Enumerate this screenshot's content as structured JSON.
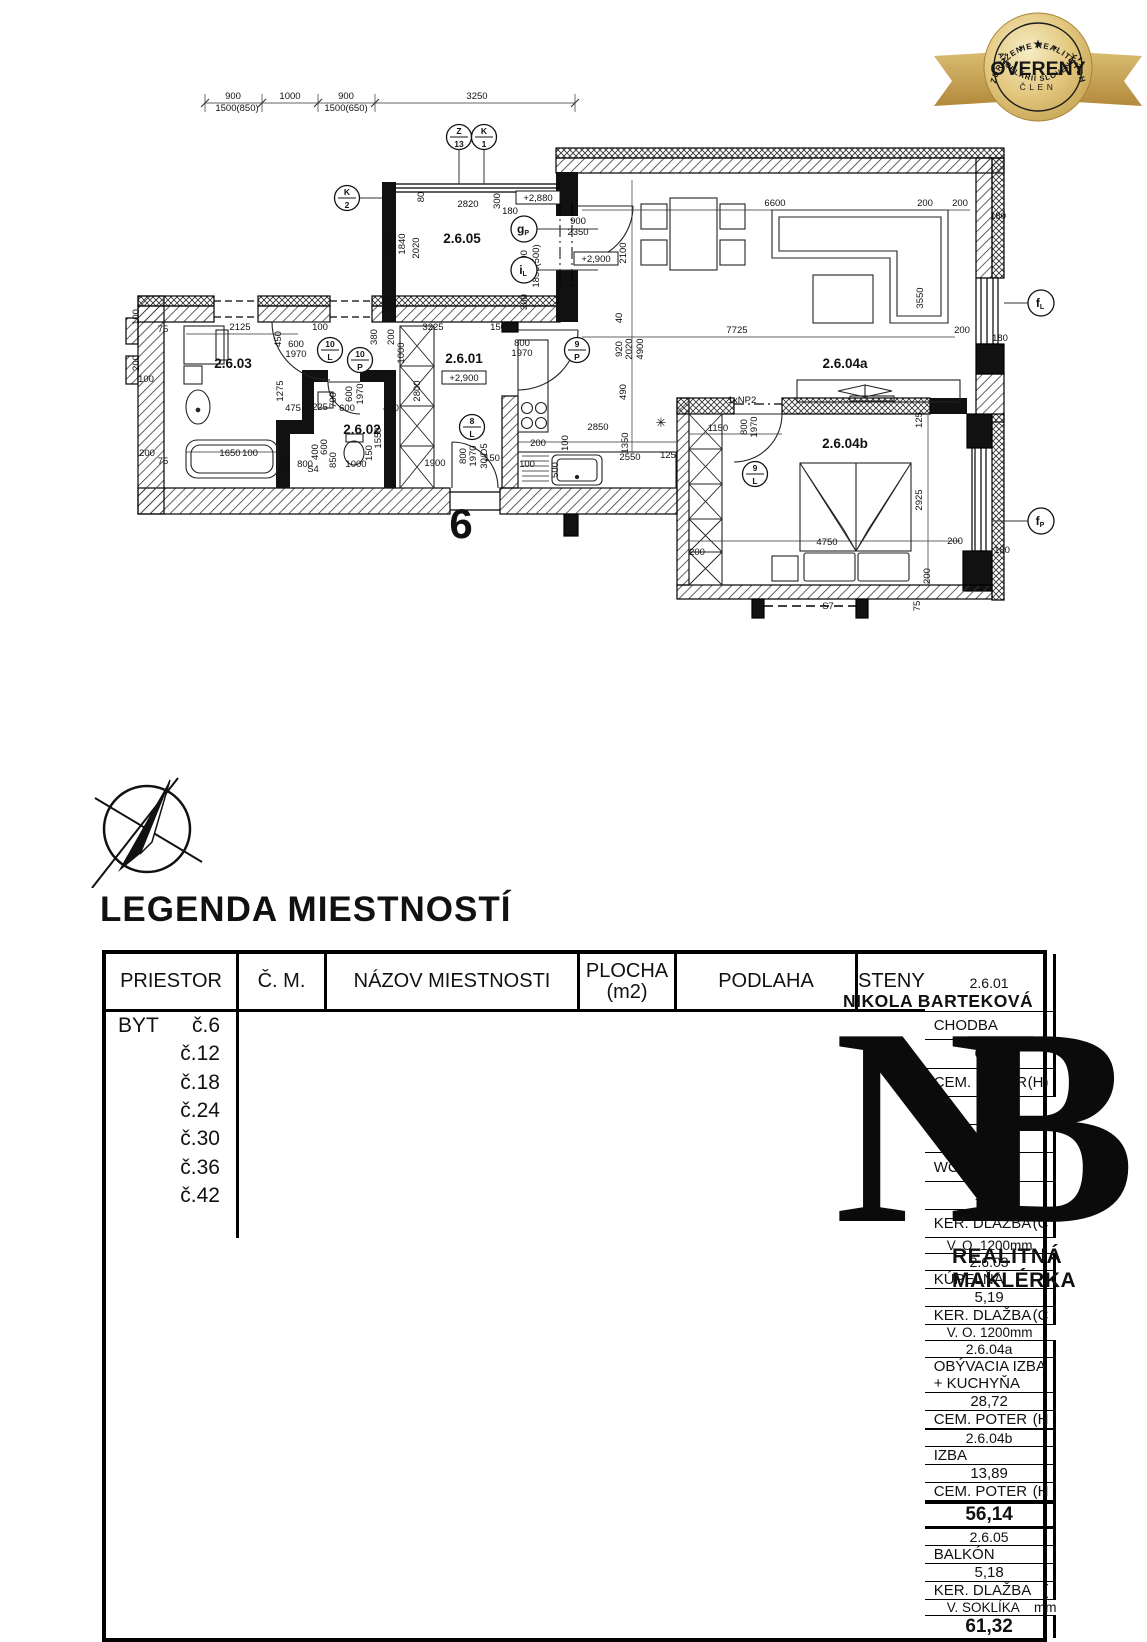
{
  "badge": {
    "top": "ZDRUŽENIE REALITNÝCH",
    "center": "OVERENÝ",
    "sub": "ČLEN",
    "bottom": "KANCELÁRIÍ SLOVENSKA",
    "gold_dark": "#b3893b",
    "gold_light": "#f3e3ae"
  },
  "legend_title": "LEGENDA  MIESTNOSTÍ",
  "table": {
    "headers": {
      "priestor": "PRIESTOR",
      "cm": "Č. M.",
      "nazov": "NÁZOV MIESTNOSTI",
      "plocha1": "PLOCHA",
      "plocha2": "(m2)",
      "podlaha": "PODLAHA",
      "steny": "STENY"
    },
    "byt": "BYT",
    "rows": [
      {
        "num": "č.6",
        "cm": "2.6.01",
        "nazov": "CHODBA",
        "plocha": "6,64",
        "podlaha": "CEM. POTER",
        "kod": "(H)",
        "steny": "",
        "total": false
      },
      {
        "num": "č.12",
        "cm": "2.6.02",
        "nazov": "WC",
        "plocha": "1,70",
        "podlaha": "KER. DLAŽBA",
        "kod": "(C",
        "steny": "V. O. 1200mm",
        "total": false
      },
      {
        "num": "č.18",
        "cm": "2.6.03",
        "nazov": "KÚPELŇA",
        "plocha": "5,19",
        "podlaha": "KER. DLAŽBA",
        "kod": "(C",
        "steny": "V. O. 1200mm",
        "total": false
      },
      {
        "num": "č.24",
        "cm": "2.6.04a",
        "nazov": "OBÝVACIA IZBA + KUCHYŇA",
        "plocha": "28,72",
        "podlaha": "CEM. POTER",
        "kod": "(H",
        "steny": "",
        "total": false
      },
      {
        "num": "č.30",
        "cm": "2.6.04b",
        "nazov": "IZBA",
        "plocha": "13,89",
        "podlaha": "CEM. POTER",
        "kod": "(H",
        "steny": "",
        "total": false
      },
      {
        "num": "č.36",
        "cm": "",
        "nazov": "",
        "plocha": "56,14",
        "podlaha": "",
        "kod": "",
        "steny": "",
        "total": true
      },
      {
        "num": "č.42",
        "cm": "2.6.05",
        "nazov": "BALKÓN",
        "plocha": "5,18",
        "podlaha": "KER. DLAŽBA",
        "kod": "(",
        "steny": "V. SOKLÍKA    mm",
        "total": false
      },
      {
        "num": "",
        "cm": "",
        "nazov": "",
        "plocha": "61,32",
        "podlaha": "",
        "kod": "",
        "steny": "",
        "total": true
      }
    ]
  },
  "watermark": {
    "name": "NIKOLA BARTEKOVÁ",
    "monogram_n": "N",
    "monogram_b": "B",
    "role": "REALITNÁ MAKLÉRKA"
  },
  "plan": {
    "big_number": "6",
    "rooms": [
      {
        "t": "2.6.05",
        "x": 462,
        "y": 243
      },
      {
        "t": "2.6.01",
        "x": 464,
        "y": 363
      },
      {
        "t": "2.6.02",
        "x": 362,
        "y": 434
      },
      {
        "t": "2.6.03",
        "x": 233,
        "y": 368
      },
      {
        "t": "2.6.04a",
        "x": 845,
        "y": 368
      },
      {
        "t": "2.6.04b",
        "x": 845,
        "y": 448
      }
    ],
    "markers": [
      {
        "a": "Z",
        "b": "13",
        "x": 459,
        "y": 137
      },
      {
        "a": "K",
        "b": "1",
        "x": 484,
        "y": 137
      },
      {
        "a": "K",
        "b": "2",
        "x": 347,
        "y": 198
      },
      {
        "a": "10",
        "b": "L",
        "x": 330,
        "y": 350
      },
      {
        "a": "10",
        "b": "P",
        "x": 360,
        "y": 360
      },
      {
        "a": "9",
        "b": "P",
        "x": 577,
        "y": 350
      },
      {
        "a": "8",
        "b": "L",
        "x": 472,
        "y": 427
      },
      {
        "a": "9",
        "b": "L",
        "x": 755,
        "y": 474
      }
    ],
    "letter_markers": [
      {
        "a": "g",
        "b": "P",
        "x": 524,
        "y": 229
      },
      {
        "a": "i",
        "b": "L",
        "x": 524,
        "y": 270
      },
      {
        "a": "f",
        "b": "L",
        "x": 1041,
        "y": 303
      },
      {
        "a": "f",
        "b": "P",
        "x": 1041,
        "y": 521
      }
    ],
    "elevations": [
      {
        "t": "+2,880",
        "x": 538,
        "y": 200
      },
      {
        "t": "+2,900",
        "x": 596,
        "y": 261
      },
      {
        "t": "+2,900",
        "x": 464,
        "y": 380
      }
    ],
    "annotations": [
      {
        "t": "1xNP2",
        "x": 742,
        "y": 403
      },
      {
        "t": "S4",
        "x": 313,
        "y": 472
      },
      {
        "t": "S7",
        "x": 828,
        "y": 609
      },
      {
        "t": "✳",
        "x": 661,
        "y": 427
      }
    ],
    "dims": [
      {
        "t": "900",
        "x": 233,
        "y": 99
      },
      {
        "t": "1000",
        "x": 290,
        "y": 99
      },
      {
        "t": "900",
        "x": 346,
        "y": 99
      },
      {
        "t": "3250",
        "x": 477,
        "y": 99
      },
      {
        "t": "1500(850)",
        "x": 237,
        "y": 111
      },
      {
        "t": "1500(650)",
        "x": 346,
        "y": 111
      },
      {
        "t": "2820",
        "x": 468,
        "y": 207
      },
      {
        "t": "180",
        "x": 510,
        "y": 214
      },
      {
        "t": "300",
        "x": 500,
        "y": 201,
        "r": 1
      },
      {
        "t": "80",
        "x": 424,
        "y": 197,
        "r": 1
      },
      {
        "t": "1920",
        "x": 391,
        "y": 244,
        "r": 1
      },
      {
        "t": "1840",
        "x": 405,
        "y": 244,
        "r": 1
      },
      {
        "t": "2020",
        "x": 419,
        "y": 248,
        "r": 1
      },
      {
        "t": "900",
        "x": 578,
        "y": 224
      },
      {
        "t": "2350",
        "x": 578,
        "y": 235
      },
      {
        "t": "600",
        "x": 527,
        "y": 258,
        "r": 1
      },
      {
        "t": "1850(500)",
        "x": 539,
        "y": 266,
        "r": 1
      },
      {
        "t": "300",
        "x": 527,
        "y": 302,
        "r": 1
      },
      {
        "t": "180",
        "x": 392,
        "y": 303,
        "r": 1
      },
      {
        "t": "6600",
        "x": 775,
        "y": 206
      },
      {
        "t": "200",
        "x": 925,
        "y": 206
      },
      {
        "t": "200",
        "x": 960,
        "y": 206
      },
      {
        "t": "180",
        "x": 998,
        "y": 219
      },
      {
        "t": "2100",
        "x": 626,
        "y": 253,
        "r": 1
      },
      {
        "t": "3550",
        "x": 923,
        "y": 298,
        "r": 1
      },
      {
        "t": "7725",
        "x": 737,
        "y": 333
      },
      {
        "t": "200",
        "x": 962,
        "y": 333
      },
      {
        "t": "180",
        "x": 1000,
        "y": 341
      },
      {
        "t": "40",
        "x": 622,
        "y": 318,
        "r": 1
      },
      {
        "t": "920",
        "x": 622,
        "y": 349,
        "r": 1
      },
      {
        "t": "2020",
        "x": 632,
        "y": 349,
        "r": 1
      },
      {
        "t": "4900",
        "x": 643,
        "y": 349,
        "r": 1
      },
      {
        "t": "490",
        "x": 626,
        "y": 392,
        "r": 1
      },
      {
        "t": "2125",
        "x": 240,
        "y": 330
      },
      {
        "t": "100",
        "x": 320,
        "y": 330
      },
      {
        "t": "450",
        "x": 281,
        "y": 339,
        "r": 1
      },
      {
        "t": "600",
        "x": 296,
        "y": 347
      },
      {
        "t": "1970",
        "x": 296,
        "y": 357
      },
      {
        "t": "380",
        "x": 377,
        "y": 337,
        "r": 1
      },
      {
        "t": "200",
        "x": 394,
        "y": 337,
        "r": 1
      },
      {
        "t": "1000",
        "x": 404,
        "y": 353,
        "r": 1
      },
      {
        "t": "3225",
        "x": 433,
        "y": 330
      },
      {
        "t": "150",
        "x": 498,
        "y": 330
      },
      {
        "t": "800",
        "x": 522,
        "y": 346
      },
      {
        "t": "1970",
        "x": 522,
        "y": 356
      },
      {
        "t": "1275",
        "x": 283,
        "y": 391,
        "r": 1
      },
      {
        "t": "475",
        "x": 293,
        "y": 411
      },
      {
        "t": "225",
        "x": 320,
        "y": 410
      },
      {
        "t": "700",
        "x": 336,
        "y": 400,
        "r": 1
      },
      {
        "t": "600",
        "x": 347,
        "y": 411
      },
      {
        "t": "400",
        "x": 391,
        "y": 411
      },
      {
        "t": "600",
        "x": 352,
        "y": 394,
        "r": 1
      },
      {
        "t": "1970",
        "x": 363,
        "y": 394,
        "r": 1
      },
      {
        "t": "1550",
        "x": 381,
        "y": 438,
        "r": 1
      },
      {
        "t": "2800",
        "x": 420,
        "y": 391,
        "r": 1
      },
      {
        "t": "1650",
        "x": 230,
        "y": 456
      },
      {
        "t": "100",
        "x": 250,
        "y": 456
      },
      {
        "t": "200",
        "x": 147,
        "y": 456
      },
      {
        "t": "75",
        "x": 163,
        "y": 332
      },
      {
        "t": "75",
        "x": 163,
        "y": 464
      },
      {
        "t": "100",
        "x": 139,
        "y": 317,
        "r": 1
      },
      {
        "t": "200",
        "x": 139,
        "y": 363,
        "r": 1
      },
      {
        "t": "100",
        "x": 146,
        "y": 382
      },
      {
        "t": "900",
        "x": 289,
        "y": 463,
        "r": 1
      },
      {
        "t": "800",
        "x": 305,
        "y": 467
      },
      {
        "t": "400",
        "x": 318,
        "y": 452,
        "r": 1
      },
      {
        "t": "600",
        "x": 327,
        "y": 447,
        "r": 1
      },
      {
        "t": "850",
        "x": 336,
        "y": 460,
        "r": 1
      },
      {
        "t": "1000",
        "x": 356,
        "y": 467
      },
      {
        "t": "150",
        "x": 372,
        "y": 453,
        "r": 1
      },
      {
        "t": "1900",
        "x": 435,
        "y": 466
      },
      {
        "t": "150",
        "x": 492,
        "y": 461
      },
      {
        "t": "800",
        "x": 466,
        "y": 456,
        "r": 1
      },
      {
        "t": "1970",
        "x": 476,
        "y": 456,
        "r": 1
      },
      {
        "t": "30/D5",
        "x": 487,
        "y": 456,
        "r": 1
      },
      {
        "t": "2850",
        "x": 598,
        "y": 430
      },
      {
        "t": "1350",
        "x": 628,
        "y": 443,
        "r": 1
      },
      {
        "t": "200",
        "x": 538,
        "y": 446
      },
      {
        "t": "100",
        "x": 568,
        "y": 443,
        "r": 1
      },
      {
        "t": "500",
        "x": 558,
        "y": 470,
        "r": 1
      },
      {
        "t": "2550",
        "x": 630,
        "y": 460
      },
      {
        "t": "125",
        "x": 668,
        "y": 458
      },
      {
        "t": "100",
        "x": 527,
        "y": 467
      },
      {
        "t": "1150",
        "x": 718,
        "y": 431
      },
      {
        "t": "800",
        "x": 747,
        "y": 427,
        "r": 1
      },
      {
        "t": "1970",
        "x": 757,
        "y": 427,
        "r": 1
      },
      {
        "t": "125",
        "x": 922,
        "y": 420,
        "r": 1
      },
      {
        "t": "2925",
        "x": 922,
        "y": 500,
        "r": 1
      },
      {
        "t": "4750",
        "x": 827,
        "y": 545
      },
      {
        "t": "200",
        "x": 955,
        "y": 544
      },
      {
        "t": "180",
        "x": 1002,
        "y": 553
      },
      {
        "t": "200",
        "x": 930,
        "y": 576,
        "r": 1
      },
      {
        "t": "75",
        "x": 920,
        "y": 606,
        "r": 1
      },
      {
        "t": "200",
        "x": 697,
        "y": 555
      }
    ]
  }
}
